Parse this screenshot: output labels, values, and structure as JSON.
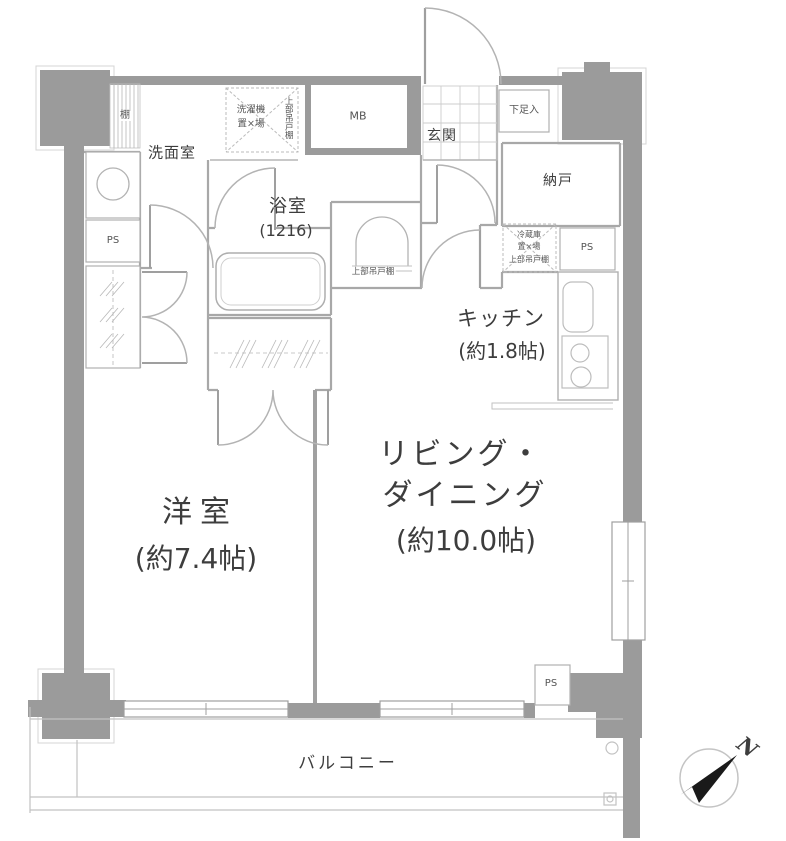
{
  "colors": {
    "wall_fill": "#9b9b9b",
    "line": "#a8a8a8",
    "text": "#3d3d3d"
  },
  "rooms": {
    "washroom": "洗面室",
    "bathroom": "浴室",
    "bathroom_size": "(1216)",
    "entrance": "玄関",
    "shoe_cabinet": "下足入",
    "meter_box": "MB",
    "storage_room": "納戸",
    "kitchen": "キッチン",
    "kitchen_size": "(約1.8帖)",
    "living_dining_line1": "リビング・",
    "living_dining_line2": "ダイニング",
    "living_dining_size": "(約10.0帖)",
    "western_room": "洋室",
    "western_room_size": "(約7.4帖)",
    "balcony": "バルコニー"
  },
  "annotations": {
    "shelf": "棚",
    "washer_line1": "洗濯機",
    "washer_line2": "置×場",
    "washer_upper_cabinet": "上部吊戸棚",
    "toilet_upper_cabinet": "上部吊戸棚",
    "fridge_line1": "冷蔵庫",
    "fridge_line2": "置×場",
    "fridge_line3": "上部吊戸棚",
    "ps_left": "PS",
    "ps_right": "PS",
    "ps_bottom": "PS",
    "compass_north": "N"
  }
}
